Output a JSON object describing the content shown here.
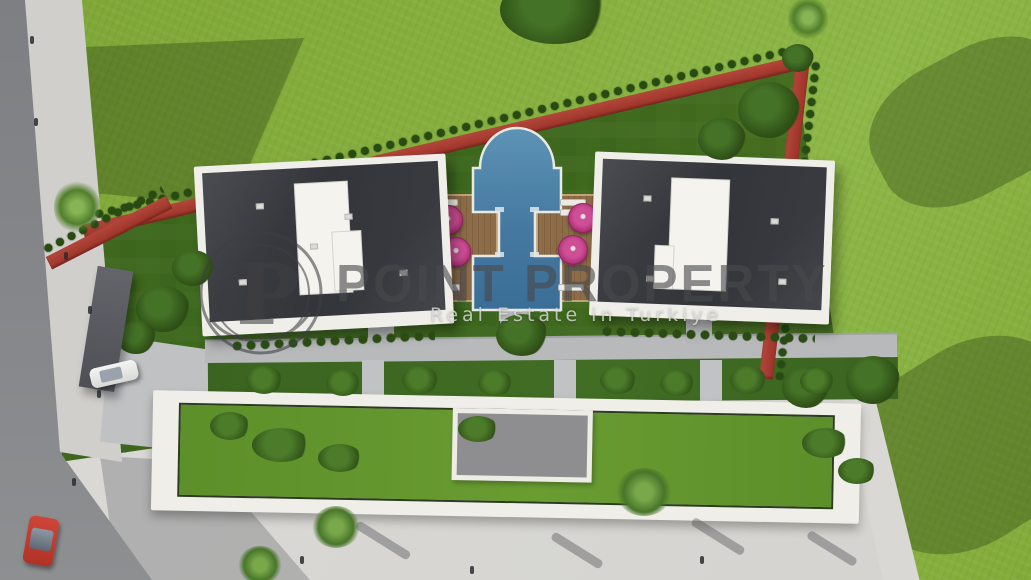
{
  "image": {
    "kind": "3d-aerial-architectural-render",
    "subject": "Top-down site plan render of a villa development: two dark-roofed villas flanking a keyhole-shaped pool with sun decks, pink umbrellas, red jogging track boundary hedge, lower garden-roof building, roads, pavement, cars and lawns"
  },
  "watermark": {
    "logo_letter": "P",
    "title": "POINT PROPERTY",
    "subtitle": "Real Estate in Turkiye"
  },
  "colors": {
    "field_green": "#86af3e",
    "lawn_green": "#3c671d",
    "track_red": "#a6362c",
    "roof_dark": "#33353a",
    "frame_white": "#efeee8",
    "pool_blue": "#4a80a8",
    "deck_wood": "#8d6c48",
    "umbrella_pink": "#bf3780",
    "road_gray": "#86888b",
    "plaza_gray": "#dbdad6",
    "watermark_gray": "#49494c",
    "car_red": "#bf3a2c",
    "car_white": "#f2f2f0"
  },
  "scene": {
    "elements": [
      "villa-left",
      "villa-right",
      "swimming-pool",
      "sun-deck-left",
      "sun-deck-right",
      "umbrellas",
      "jogging-track",
      "boundary-hedge",
      "lower-building-roof-garden",
      "walkway",
      "entry-court",
      "gate-canopy",
      "road",
      "sidewalk",
      "plaza",
      "red-car",
      "white-car",
      "lawns",
      "trees"
    ]
  }
}
